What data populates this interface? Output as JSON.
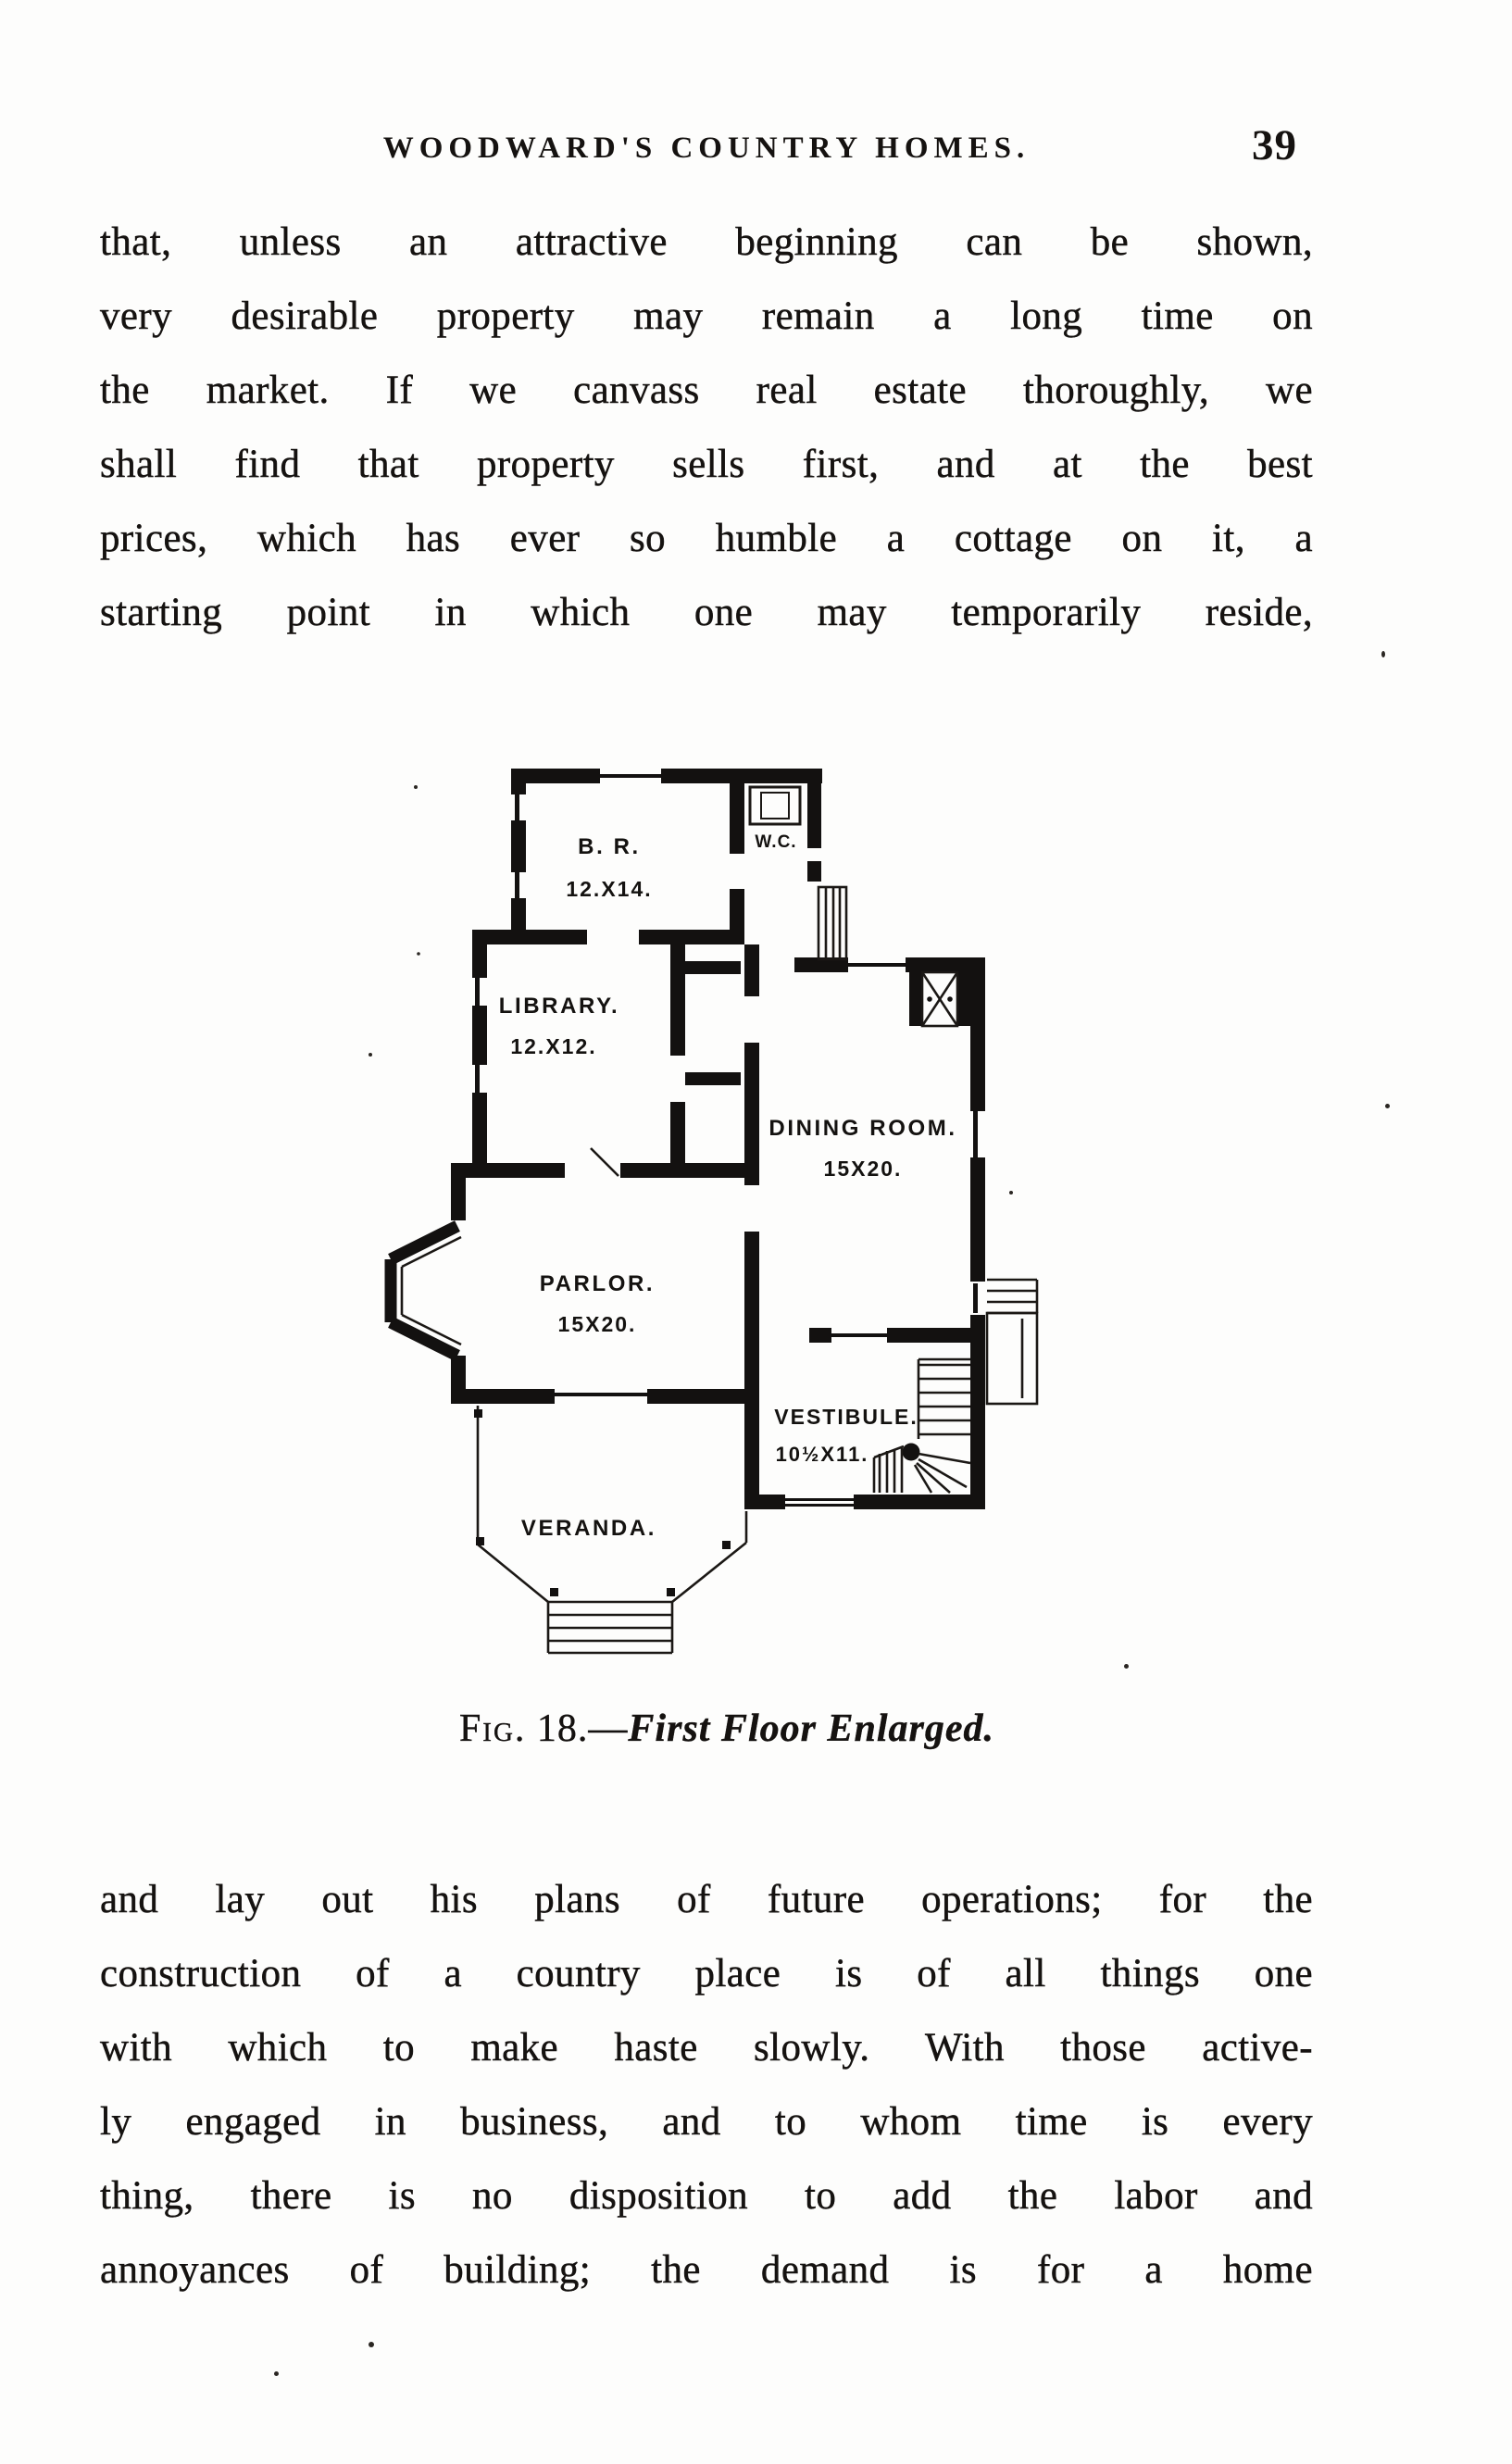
{
  "header": {
    "title": "WOODWARD'S COUNTRY HOMES.",
    "page_number": "39"
  },
  "paragraph_top": {
    "lines": [
      "that, unless an attractive beginning can be shown,",
      "very desirable property may remain a long time on",
      "the market. If we canvass real estate thoroughly, we",
      "shall find that property sells first, and at the best",
      "prices, which has ever so humble a cottage on it, a",
      "starting point in which one may temporarily reside,"
    ]
  },
  "figure": {
    "caption": {
      "fig_label": "Fig.",
      "fig_number": " 18.—",
      "title": "First Floor Enlarged."
    },
    "rooms": [
      {
        "name": "B. R.",
        "dims": "12.X14."
      },
      {
        "name": "W.C.",
        "dims": ""
      },
      {
        "name": "LIBRARY.",
        "dims": "12.X12."
      },
      {
        "name": "DINING ROOM.",
        "dims": "15X20."
      },
      {
        "name": "PARLOR.",
        "dims": "15X20."
      },
      {
        "name": "VESTIBULE.",
        "dims": "10½X11."
      },
      {
        "name": "VERANDA.",
        "dims": ""
      }
    ]
  },
  "paragraph_bottom": {
    "lines": [
      "and lay out his plans of future operations; for the",
      "construction of a country place is of all things one",
      "with which to make haste slowly. With those active-",
      "ly engaged in business, and to whom time is every",
      "thing, there is no disposition to add the labor and",
      "annoyances of building; the demand is for a home"
    ]
  },
  "colors": {
    "ink": "#151210",
    "paper": "#fdfdfc"
  }
}
